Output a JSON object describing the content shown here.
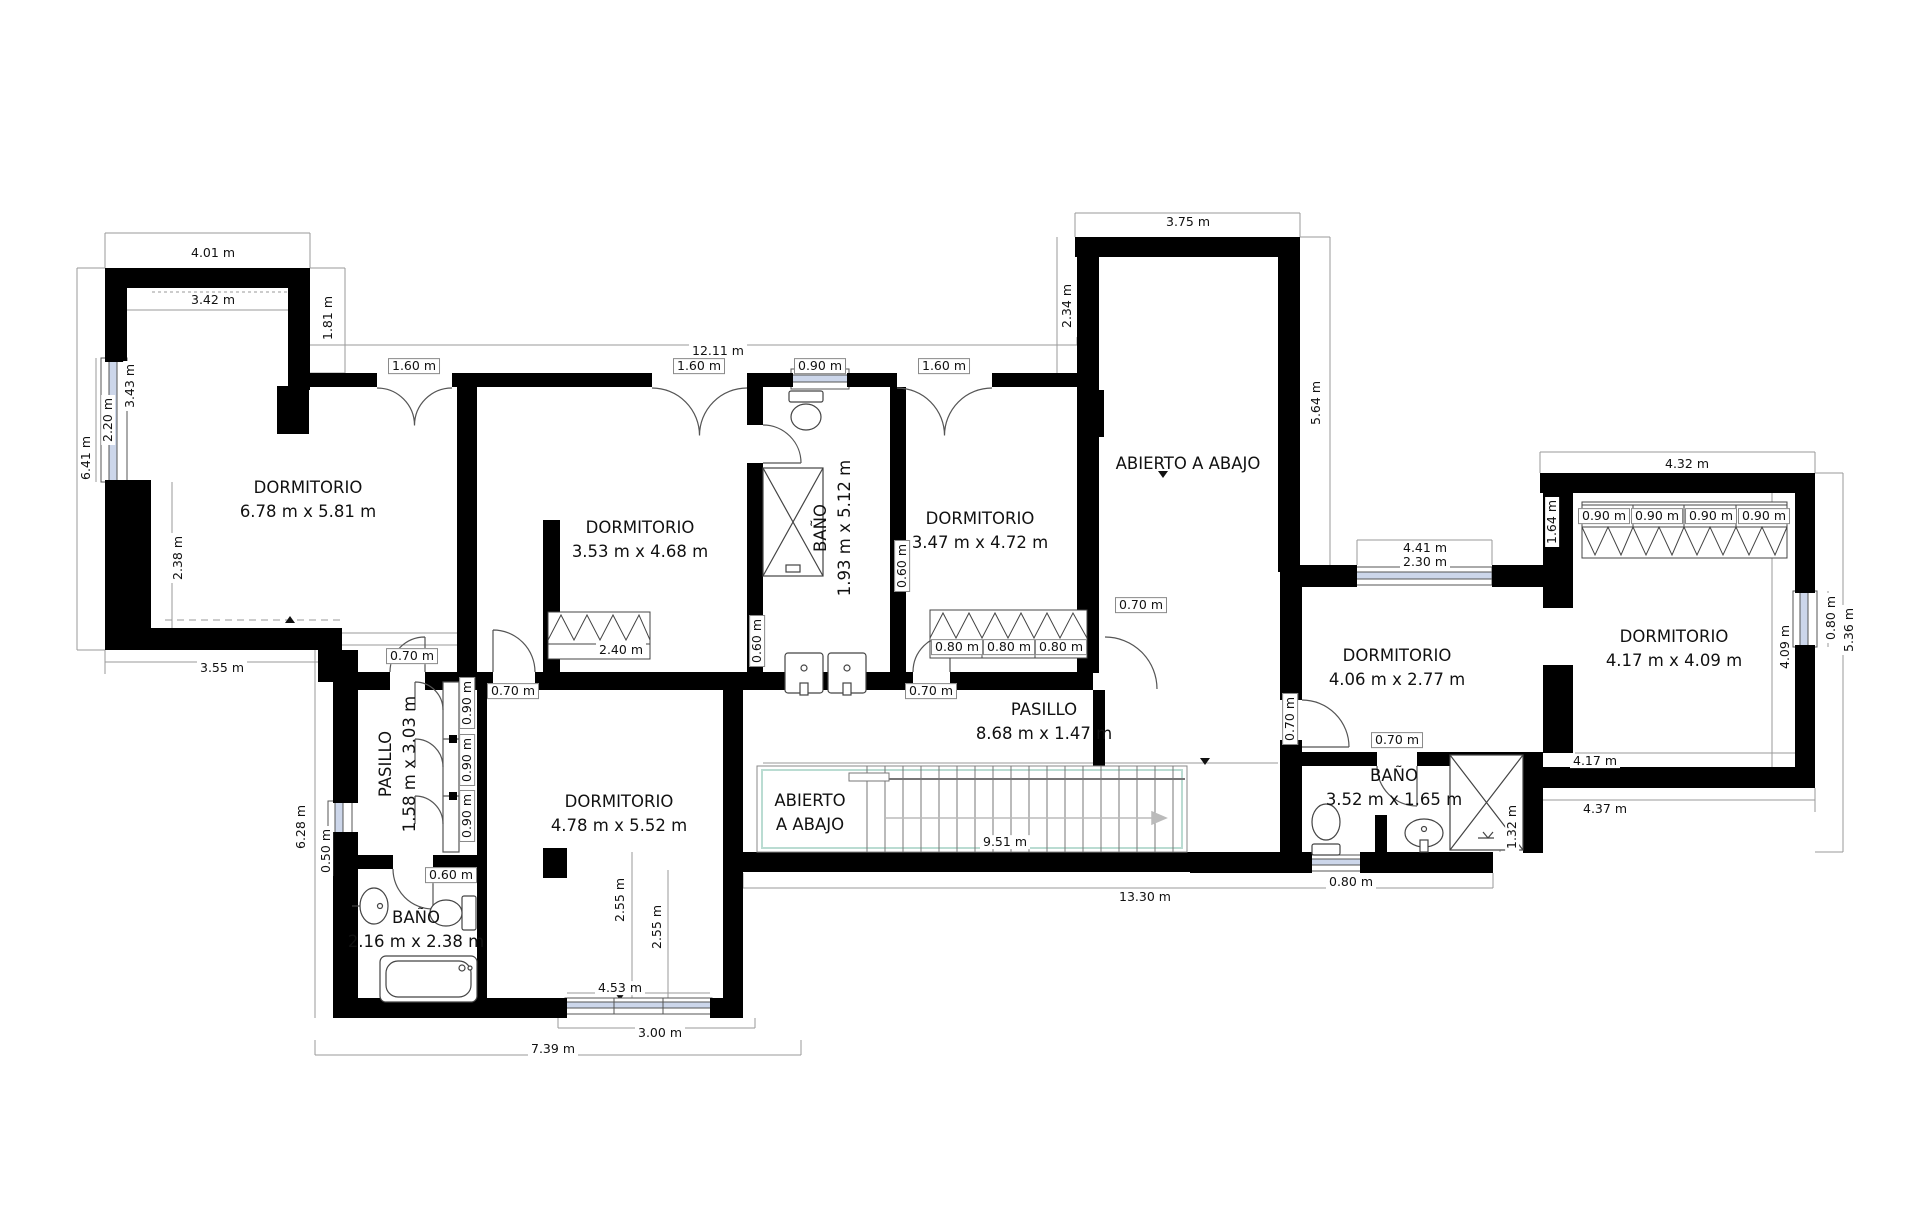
{
  "plan": {
    "wall_color": "#000000",
    "window_color": "#ccd6ea",
    "dim_line_color": "#8a8a8a",
    "stair_accent_color": "#badcd2",
    "unit": "m"
  },
  "rooms": [
    {
      "name": "dormitorio-1",
      "label": "DORMITORIO",
      "dims": "6.78 m x 5.81 m",
      "x": 308,
      "y": 500,
      "rot": false
    },
    {
      "name": "dormitorio-2",
      "label": "DORMITORIO",
      "dims": "3.53 m x 4.68 m",
      "x": 640,
      "y": 540,
      "rot": false
    },
    {
      "name": "bano-1",
      "label": "BAÑO",
      "dims": "1.93 m x 5.12 m",
      "x": 833,
      "y": 528,
      "rot": true
    },
    {
      "name": "dormitorio-3",
      "label": "DORMITORIO",
      "dims": "3.47 m x 4.72 m",
      "x": 980,
      "y": 531,
      "rot": false
    },
    {
      "name": "abierto-a-abajo-torre",
      "label": "ABIERTO A ABAJO",
      "dims": "",
      "x": 1188,
      "y": 464,
      "rot": false
    },
    {
      "name": "dormitorio-4",
      "label": "DORMITORIO",
      "dims": "4.06 m x 2.77 m",
      "x": 1397,
      "y": 668,
      "rot": false
    },
    {
      "name": "dormitorio-5",
      "label": "DORMITORIO",
      "dims": "4.17 m x 4.09 m",
      "x": 1674,
      "y": 649,
      "rot": false
    },
    {
      "name": "pasillo-1",
      "label": "PASILLO",
      "dims": "8.68 m x 1.47 m",
      "x": 1044,
      "y": 722,
      "rot": false
    },
    {
      "name": "pasillo-2",
      "label": "PASILLO",
      "dims": "1.58 m x 3.03 m",
      "x": 398,
      "y": 764,
      "rot": true
    },
    {
      "name": "dormitorio-6",
      "label": "DORMITORIO",
      "dims": "4.78 m x 5.52 m",
      "x": 619,
      "y": 814,
      "rot": false
    },
    {
      "name": "abierto-a-abajo-escalera",
      "label": "ABIERTO",
      "dims": "A ABAJO",
      "x": 810,
      "y": 813,
      "rot": false
    },
    {
      "name": "bano-2",
      "label": "BAÑO",
      "dims": "2.16 m x 2.38 m",
      "x": 416,
      "y": 930,
      "rot": false
    },
    {
      "name": "bano-3",
      "label": "BAÑO",
      "dims": "3.52 m x 1.65 m",
      "x": 1394,
      "y": 788,
      "rot": false
    }
  ],
  "dimensions": [
    {
      "text": "4.01 m",
      "x": 213,
      "y": 253,
      "rot": false,
      "boxed": false
    },
    {
      "text": "3.42 m",
      "x": 213,
      "y": 300,
      "rot": false,
      "boxed": false
    },
    {
      "text": "1.81 m",
      "x": 328,
      "y": 318,
      "rot": true,
      "boxed": false
    },
    {
      "text": "12.11 m",
      "x": 718,
      "y": 351,
      "rot": false,
      "boxed": false
    },
    {
      "text": "1.60 m",
      "x": 414,
      "y": 366,
      "rot": false,
      "boxed": true
    },
    {
      "text": "1.60 m",
      "x": 699,
      "y": 366,
      "rot": false,
      "boxed": true
    },
    {
      "text": "0.90 m",
      "x": 820,
      "y": 366,
      "rot": false,
      "boxed": true
    },
    {
      "text": "1.60 m",
      "x": 944,
      "y": 366,
      "rot": false,
      "boxed": true
    },
    {
      "text": "3.75 m",
      "x": 1188,
      "y": 222,
      "rot": false,
      "boxed": false
    },
    {
      "text": "2.34 m",
      "x": 1067,
      "y": 306,
      "rot": true,
      "boxed": false
    },
    {
      "text": "5.64 m",
      "x": 1316,
      "y": 403,
      "rot": true,
      "boxed": false
    },
    {
      "text": "6.41 m",
      "x": 86,
      "y": 458,
      "rot": true,
      "boxed": false
    },
    {
      "text": "2.20 m",
      "x": 108,
      "y": 420,
      "rot": true,
      "boxed": false
    },
    {
      "text": "3.43 m",
      "x": 130,
      "y": 386,
      "rot": true,
      "boxed": false
    },
    {
      "text": "2.38 m",
      "x": 178,
      "y": 558,
      "rot": true,
      "boxed": false
    },
    {
      "text": "3.55 m",
      "x": 222,
      "y": 668,
      "rot": false,
      "boxed": false
    },
    {
      "text": "0.70 m",
      "x": 412,
      "y": 656,
      "rot": false,
      "boxed": true
    },
    {
      "text": "0.70 m",
      "x": 513,
      "y": 691,
      "rot": false,
      "boxed": true
    },
    {
      "text": "0.70 m",
      "x": 931,
      "y": 691,
      "rot": false,
      "boxed": true
    },
    {
      "text": "0.60 m",
      "x": 902,
      "y": 566,
      "rot": true,
      "boxed": true
    },
    {
      "text": "0.60 m",
      "x": 757,
      "y": 641,
      "rot": true,
      "boxed": true
    },
    {
      "text": "2.40 m",
      "x": 621,
      "y": 650,
      "rot": false,
      "boxed": false
    },
    {
      "text": "0.80 m",
      "x": 957,
      "y": 647,
      "rot": false,
      "boxed": true
    },
    {
      "text": "0.80 m",
      "x": 1009,
      "y": 647,
      "rot": false,
      "boxed": true
    },
    {
      "text": "0.80 m",
      "x": 1061,
      "y": 647,
      "rot": false,
      "boxed": true
    },
    {
      "text": "0.70 m",
      "x": 1141,
      "y": 605,
      "rot": false,
      "boxed": true
    },
    {
      "text": "0.70 m",
      "x": 1290,
      "y": 719,
      "rot": true,
      "boxed": true
    },
    {
      "text": "0.70 m",
      "x": 1397,
      "y": 740,
      "rot": false,
      "boxed": true
    },
    {
      "text": "4.41 m",
      "x": 1425,
      "y": 548,
      "rot": false,
      "boxed": false
    },
    {
      "text": "2.30 m",
      "x": 1425,
      "y": 562,
      "rot": false,
      "boxed": false
    },
    {
      "text": "1.64 m",
      "x": 1552,
      "y": 522,
      "rot": true,
      "boxed": false
    },
    {
      "text": "4.32 m",
      "x": 1687,
      "y": 464,
      "rot": false,
      "boxed": false
    },
    {
      "text": "0.90 m",
      "x": 1604,
      "y": 516,
      "rot": false,
      "boxed": true
    },
    {
      "text": "0.90 m",
      "x": 1657,
      "y": 516,
      "rot": false,
      "boxed": true
    },
    {
      "text": "0.90 m",
      "x": 1711,
      "y": 516,
      "rot": false,
      "boxed": true
    },
    {
      "text": "0.90 m",
      "x": 1764,
      "y": 516,
      "rot": false,
      "boxed": true
    },
    {
      "text": "0.80 m",
      "x": 1831,
      "y": 618,
      "rot": true,
      "boxed": false
    },
    {
      "text": "5.36 m",
      "x": 1849,
      "y": 630,
      "rot": true,
      "boxed": false
    },
    {
      "text": "4.09 m",
      "x": 1785,
      "y": 647,
      "rot": true,
      "boxed": false
    },
    {
      "text": "4.17 m",
      "x": 1595,
      "y": 761,
      "rot": false,
      "boxed": false
    },
    {
      "text": "4.37 m",
      "x": 1605,
      "y": 809,
      "rot": false,
      "boxed": false
    },
    {
      "text": "1.32 m",
      "x": 1512,
      "y": 827,
      "rot": true,
      "boxed": false
    },
    {
      "text": "13.30 m",
      "x": 1145,
      "y": 897,
      "rot": false,
      "boxed": false
    },
    {
      "text": "9.51 m",
      "x": 1005,
      "y": 842,
      "rot": false,
      "boxed": false
    },
    {
      "text": "0.80 m",
      "x": 1351,
      "y": 882,
      "rot": false,
      "boxed": false
    },
    {
      "text": "0.90 m",
      "x": 467,
      "y": 703,
      "rot": true,
      "boxed": true
    },
    {
      "text": "0.90 m",
      "x": 467,
      "y": 760,
      "rot": true,
      "boxed": true
    },
    {
      "text": "0.90 m",
      "x": 467,
      "y": 816,
      "rot": true,
      "boxed": true
    },
    {
      "text": "0.60 m",
      "x": 451,
      "y": 875,
      "rot": false,
      "boxed": true
    },
    {
      "text": "0.50 m",
      "x": 326,
      "y": 851,
      "rot": true,
      "boxed": false
    },
    {
      "text": "6.28 m",
      "x": 301,
      "y": 827,
      "rot": true,
      "boxed": false
    },
    {
      "text": "2.55 m",
      "x": 620,
      "y": 900,
      "rot": true,
      "boxed": false
    },
    {
      "text": "2.55 m",
      "x": 657,
      "y": 927,
      "rot": true,
      "boxed": false
    },
    {
      "text": "4.53 m",
      "x": 620,
      "y": 988,
      "rot": false,
      "boxed": false
    },
    {
      "text": "3.00 m",
      "x": 660,
      "y": 1033,
      "rot": false,
      "boxed": false
    },
    {
      "text": "7.39 m",
      "x": 553,
      "y": 1049,
      "rot": false,
      "boxed": false
    }
  ]
}
